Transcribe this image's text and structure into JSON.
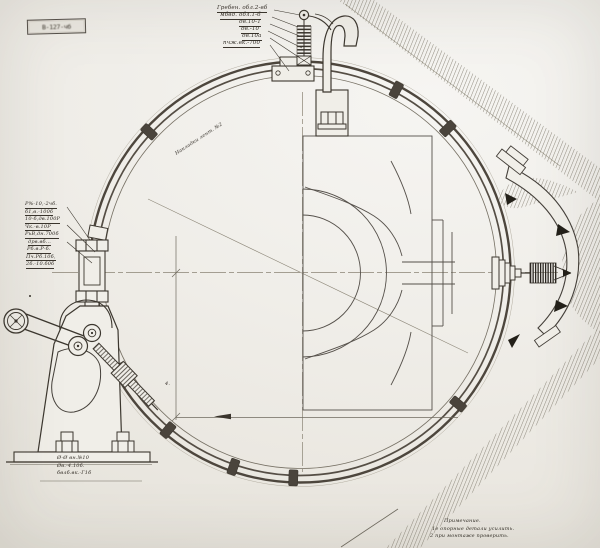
{
  "stamp": {
    "text": "В-127-чб"
  },
  "annotations": {
    "top_block": {
      "lines": [
        "Гребен. обл.2-вб",
        "мбвд. обл.1-б",
        "дв.10-1",
        "дв.-10",
        "дв.10а",
        "пчж.вк.-700"
      ]
    },
    "left_block": {
      "lines": [
        "Р%-10,-2чб.",
        "б1,в.-100б",
        "10-б,дв.100Р",
        "Чк.-в.10Р",
        "РьВ,дн.700б",
        "дрв.вб...",
        "Рб.в.Р-б.",
        "Пч.Рб.10б,",
        "2б.-10.б0б"
      ]
    },
    "diagonal_label": {
      "text": "Накладки лент. №2"
    },
    "base_label": {
      "lines": [
        "Ø-Ø вн.№10",
        "Øв.-4.10б.",
        "бвлб.вк.-Г1б"
      ]
    },
    "note": {
      "lines": [
        "Примечание.",
        "1е опорные детали усилить.",
        "2 при монтаже проверить."
      ]
    },
    "dim_mark": {
      "text": "4."
    }
  },
  "colors": {
    "paper": "#f0eee9",
    "ink_dark": "#38332c",
    "ink_thin": "#6f6a5f",
    "band": "#4d463d",
    "hatch": "#8e897d",
    "centerline": "#8a8475"
  }
}
